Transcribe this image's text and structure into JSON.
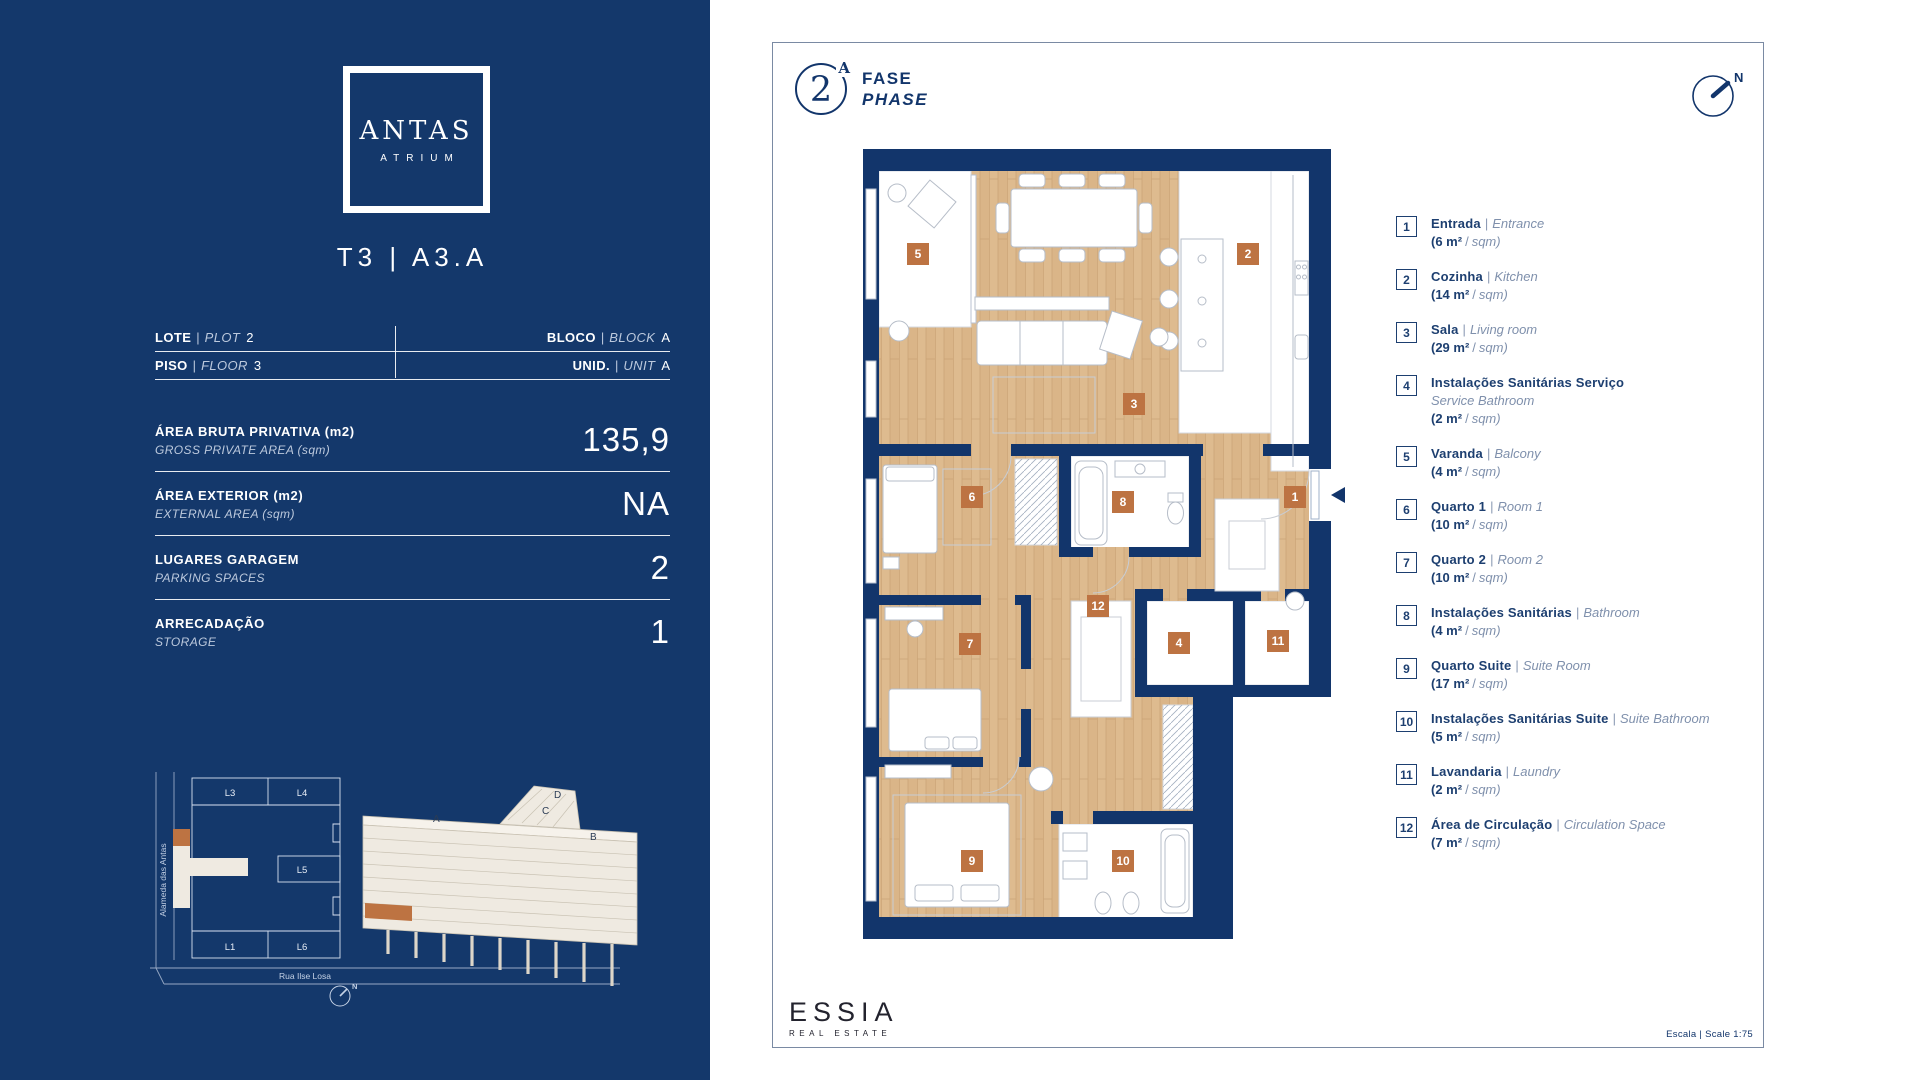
{
  "colors": {
    "navy": "#14386B",
    "wall": "#12356B",
    "marker_orange": "#BD7342",
    "wood": "#DEBB8F"
  },
  "sidebar": {
    "brand": {
      "name": "ANTAS",
      "sub": "ATRIUM"
    },
    "unit_title": "T3 | A3.A",
    "sep": "|",
    "info": [
      {
        "pt": "LOTE",
        "en": "PLOT",
        "value": "2"
      },
      {
        "pt": "BLOCO",
        "en": "BLOCK",
        "value": "A"
      },
      {
        "pt": "PISO",
        "en": "FLOOR",
        "value": "3"
      },
      {
        "pt": "UNID.",
        "en": "UNIT",
        "value": "A"
      }
    ],
    "stats": [
      {
        "pt": "ÁREA BRUTA PRIVATIVA (m2)",
        "en": "GROSS PRIVATE AREA (sqm)",
        "value": "135,9"
      },
      {
        "pt": "ÁREA EXTERIOR (m2)",
        "en": "EXTERNAL AREA (sqm)",
        "value": "NA"
      },
      {
        "pt": "LUGARES GARAGEM",
        "en": "PARKING SPACES",
        "value": "2"
      },
      {
        "pt": "ARRECADAÇÃO",
        "en": "STORAGE",
        "value": "1"
      }
    ],
    "siteplan": {
      "street_left": "Alameda das Antas",
      "street_bottom": "Rua Ilse Losa",
      "lots": [
        "L3",
        "L4",
        "L5",
        "L1",
        "L6"
      ],
      "blocks": [
        "A",
        "B",
        "C",
        "D"
      ],
      "north": "N"
    }
  },
  "panel": {
    "phase": {
      "number": "2",
      "sup": "A",
      "pt": "FASE",
      "en": "PHASE"
    },
    "north": "N",
    "brand": {
      "name": "ESSIA",
      "sub": "REAL ESTATE"
    },
    "scale": "Escala | Scale 1:75"
  },
  "plan": {
    "markers": [
      "1",
      "2",
      "3",
      "4",
      "5",
      "6",
      "7",
      "8",
      "9",
      "10",
      "11",
      "12"
    ]
  },
  "legend": {
    "slash": "/",
    "sqm": "sqm)",
    "items": [
      {
        "n": "1",
        "pt": "Entrada",
        "sep": "|",
        "en": "Entrance",
        "en2": "",
        "area": "(6 m²"
      },
      {
        "n": "2",
        "pt": "Cozinha",
        "sep": "|",
        "en": "Kitchen",
        "en2": "",
        "area": "(14 m²"
      },
      {
        "n": "3",
        "pt": "Sala",
        "sep": "|",
        "en": "Living room",
        "en2": "",
        "area": "(29 m²"
      },
      {
        "n": "4",
        "pt": "Instalações Sanitárias Serviço",
        "sep": "",
        "en": "",
        "en2": "Service Bathroom",
        "area": "(2 m²"
      },
      {
        "n": "5",
        "pt": "Varanda",
        "sep": "|",
        "en": "Balcony",
        "en2": "",
        "area": "(4 m²"
      },
      {
        "n": "6",
        "pt": "Quarto 1",
        "sep": "|",
        "en": "Room 1",
        "en2": "",
        "area": "(10 m²"
      },
      {
        "n": "7",
        "pt": "Quarto 2",
        "sep": "|",
        "en": "Room 2",
        "en2": "",
        "area": "(10 m²"
      },
      {
        "n": "8",
        "pt": "Instalações Sanitárias",
        "sep": "|",
        "en": "Bathroom",
        "en2": "",
        "area": "(4 m²"
      },
      {
        "n": "9",
        "pt": "Quarto Suite",
        "sep": "|",
        "en": "Suite Room",
        "en2": "",
        "area": "(17 m²"
      },
      {
        "n": "10",
        "pt": "Instalações Sanitárias Suite",
        "sep": "|",
        "en": "Suite Bathroom",
        "en2": "",
        "area": "(5 m²"
      },
      {
        "n": "11",
        "pt": "Lavandaria",
        "sep": "|",
        "en": "Laundry",
        "en2": "",
        "area": "(2 m²"
      },
      {
        "n": "12",
        "pt": "Área de Circulação",
        "sep": "|",
        "en": "Circulation Space",
        "en2": "",
        "area": "(7 m²"
      }
    ]
  }
}
